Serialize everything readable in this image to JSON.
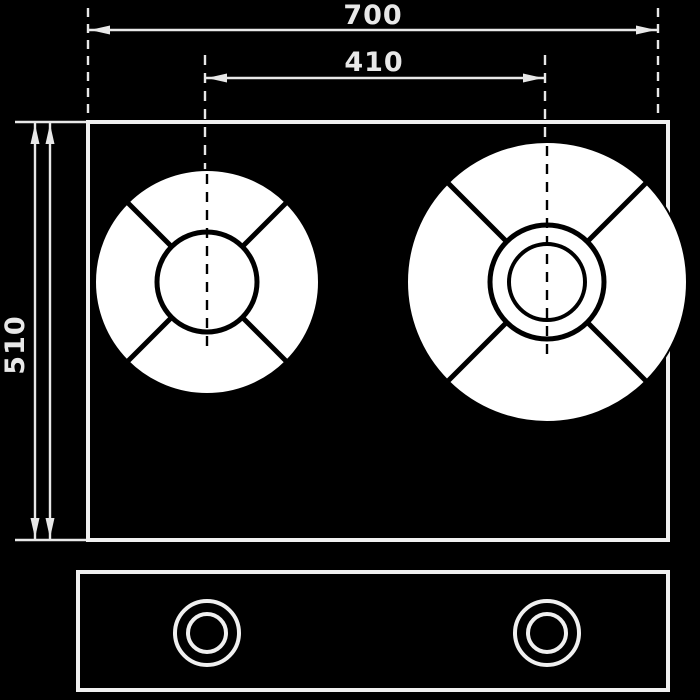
{
  "drawing": {
    "type": "technical-drawing",
    "subject": "two-burner gas hob, top view with front control panel view",
    "colors": {
      "background": "#000000",
      "line": "#f0f0f0",
      "burner_fill": "#ffffff",
      "burner_line": "#000000"
    },
    "dimensions": {
      "overall_width": {
        "label": "700"
      },
      "burner_spacing": {
        "label": "410"
      },
      "overall_depth": {
        "label": "510"
      }
    }
  }
}
